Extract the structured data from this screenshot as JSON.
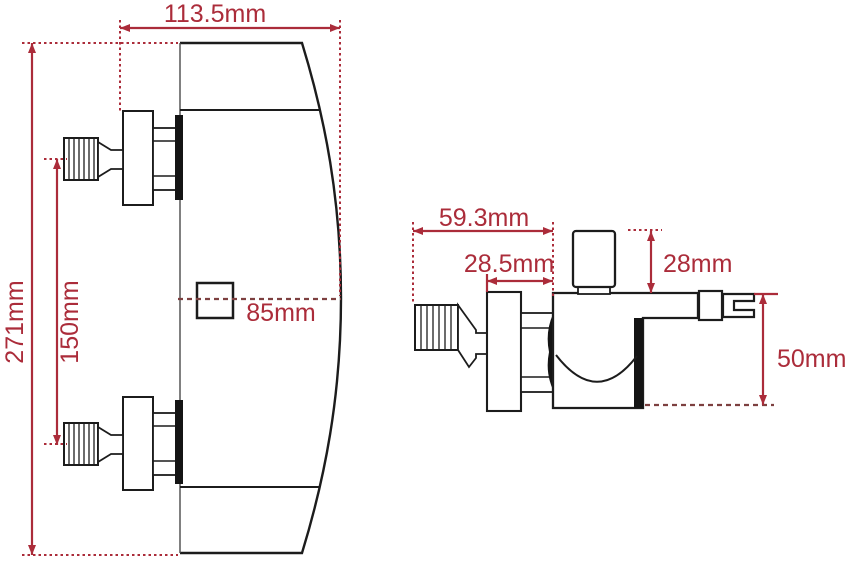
{
  "diagram": {
    "type": "technical-drawing",
    "subject": "wall-mounted shower mixer valve dimension drawing",
    "views": [
      {
        "id": "front",
        "dimensions": {
          "width": "113.5mm",
          "height": "271mm",
          "inlet_spacing": "150mm",
          "depth": "85mm"
        }
      },
      {
        "id": "side",
        "dimensions": {
          "total_depth": "59.3mm",
          "wall_to_body": "28.5mm",
          "knob_height": "28mm",
          "body_height": "50mm"
        }
      }
    ],
    "colors": {
      "dimension_red": "#ab2c3a",
      "dashed_maroon": "#7d4040",
      "line_black": "#1c1c1c",
      "background": "#ffffff"
    }
  }
}
